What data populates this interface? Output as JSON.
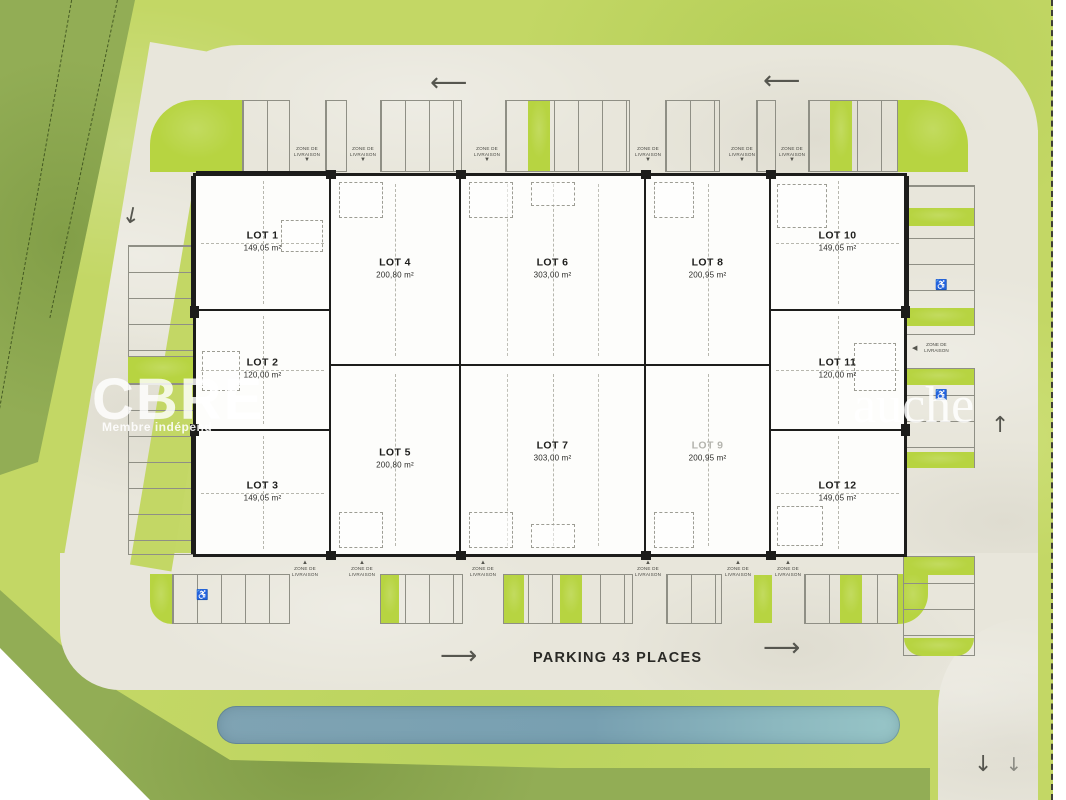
{
  "plan": {
    "parking_label": "PARKING 43 PLACES",
    "delivery_zone_label": "ZONE DE LIVRAISON",
    "lots": [
      {
        "name": "LOT 1",
        "area": "149,05 m²"
      },
      {
        "name": "LOT 2",
        "area": "120,00 m²"
      },
      {
        "name": "LOT 3",
        "area": "149,05 m²"
      },
      {
        "name": "LOT 4",
        "area": "200,80 m²"
      },
      {
        "name": "LOT 5",
        "area": "200,80 m²"
      },
      {
        "name": "LOT 6",
        "area": "303,00 m²"
      },
      {
        "name": "LOT 7",
        "area": "303,00 m²"
      },
      {
        "name": "LOT 8",
        "area": "200,95 m²"
      },
      {
        "name": "LOT 9",
        "area": "200,95 m²"
      },
      {
        "name": "LOT 10",
        "area": "149,05 m²"
      },
      {
        "name": "LOT 11",
        "area": "120,00 m²"
      },
      {
        "name": "LOT 12",
        "area": "149,05 m²"
      }
    ],
    "watermarks": {
      "brand": "CBRE",
      "brand_sub": "Membre indépend",
      "right_fragment": "auche"
    },
    "icons": {
      "accessible": "♿",
      "triangle_down": "▼",
      "triangle_up": "▲",
      "triangle_left": "◀",
      "arrow_left": "⟵",
      "arrow_right": "⟶",
      "arrow_up": "↑",
      "arrow_down": "↓"
    },
    "colors": {
      "grass_light": "#c3d765",
      "grass_dark": "#92ad55",
      "pavement": "#e8e6db",
      "stall_green": "#b7d441",
      "water": "#7fa6b6",
      "building": "#fdfdfb",
      "wall": "#1d1d1b"
    }
  }
}
